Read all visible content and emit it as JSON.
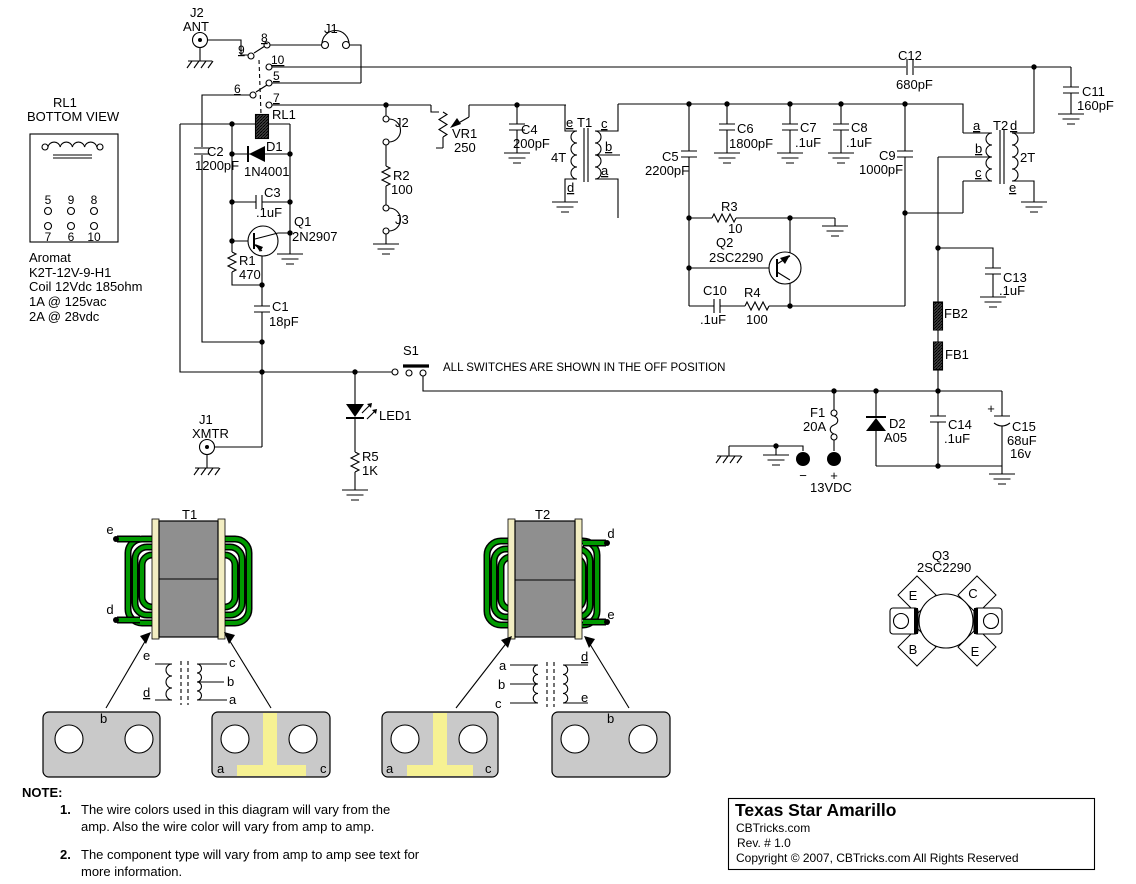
{
  "schematic_note": "ALL SWITCHES ARE SHOWN IN THE OFF POSITION",
  "title_block": {
    "title": "Texas Star  Amarillo",
    "site": "CBTricks.com",
    "rev": "Rev. # 1.0",
    "copyright": "Copyright © 2007, CBTricks.com All Rights Reserved"
  },
  "notes": {
    "heading": "NOTE:",
    "item1_num": "1.",
    "item1_line1": "The wire colors used in this diagram will vary from the",
    "item1_line2": "amp. Also the wire color will vary from amp to amp.",
    "item2_num": "2.",
    "item2_line1": "The component type will vary from amp to amp see text for",
    "item2_line2": "more information."
  },
  "relay_detail": {
    "ref": "RL1",
    "view": "BOTTOM VIEW",
    "pins_top": [
      "5",
      "9",
      "8"
    ],
    "pins_bottom": [
      "7",
      "6",
      "10"
    ],
    "mfr": "Aromat",
    "part": "K2T-12V-9-H1",
    "coil": "Coil 12Vdc  185ohm",
    "rating1": "1A @ 125vac",
    "rating2": "2A @ 28vdc"
  },
  "relay_pins": {
    "p5": "5",
    "p6": "6",
    "p7": "7",
    "p8": "8",
    "p9": "9",
    "p10": "10"
  },
  "components": {
    "J2_ANT": {
      "ref": "J2",
      "label": "ANT"
    },
    "J1_TOP": {
      "ref": "J1"
    },
    "J1_XMTR": {
      "ref": "J1",
      "label": "XMTR"
    },
    "J2_JMP": {
      "ref": "J2"
    },
    "J3_JMP": {
      "ref": "J3"
    },
    "RL1": {
      "ref": "RL1"
    },
    "S1": {
      "ref": "S1"
    },
    "LED1": {
      "ref": "LED1"
    },
    "C1": {
      "ref": "C1",
      "value": "18pF"
    },
    "C2": {
      "ref": "C2",
      "value": "1200pF"
    },
    "C3": {
      "ref": "C3",
      "value": ".1uF"
    },
    "C4": {
      "ref": "C4",
      "value": "200pF"
    },
    "C5": {
      "ref": "C5",
      "value": "2200pF"
    },
    "C6": {
      "ref": "C6",
      "value": "1800pF"
    },
    "C7": {
      "ref": "C7",
      "value": ".1uF"
    },
    "C8": {
      "ref": "C8",
      "value": ".1uF"
    },
    "C9": {
      "ref": "C9",
      "value": "1000pF"
    },
    "C10": {
      "ref": "C10",
      "value": ".1uF"
    },
    "C11": {
      "ref": "C11",
      "value": "160pF"
    },
    "C12": {
      "ref": "C12",
      "value": "680pF"
    },
    "C13": {
      "ref": "C13",
      "value": ".1uF"
    },
    "C14": {
      "ref": "C14",
      "value": ".1uF"
    },
    "C15": {
      "ref": "C15",
      "value": "68uF",
      "value2": "16v"
    },
    "R1": {
      "ref": "R1",
      "value": "470"
    },
    "R2": {
      "ref": "R2",
      "value": "100"
    },
    "R3": {
      "ref": "R3",
      "value": "10"
    },
    "R4": {
      "ref": "R4",
      "value": "100"
    },
    "R5": {
      "ref": "R5",
      "value": "1K"
    },
    "VR1": {
      "ref": "VR1",
      "value": "250"
    },
    "D1": {
      "ref": "D1",
      "value": "1N4001"
    },
    "D2": {
      "ref": "D2",
      "value": "A05"
    },
    "Q1": {
      "ref": "Q1",
      "value": "2N2907"
    },
    "Q2": {
      "ref": "Q2",
      "value": "2SC2290"
    },
    "FB1": {
      "ref": "FB1"
    },
    "FB2": {
      "ref": "FB2"
    },
    "T1": {
      "ref": "T1",
      "turns": "4T",
      "a": "a",
      "b": "b",
      "c": "c",
      "d": "d",
      "e": "e"
    },
    "T2": {
      "ref": "T2",
      "turns": "2T",
      "a": "a",
      "b": "b",
      "c": "c",
      "d": "d",
      "e": "e"
    }
  },
  "power": {
    "fuse_ref": "F1",
    "fuse_value": "20A",
    "plus": "+",
    "minus": "−",
    "supply": "13VDC",
    "c15_plus": "+"
  },
  "t1_detail": {
    "ref": "T1",
    "lead_e": "e",
    "lead_d": "d",
    "win_e": "e",
    "win_d": "d",
    "win_c": "c",
    "win_b": "b",
    "win_a": "a",
    "lug_b": "b",
    "lug_a": "a",
    "lug_c": "c"
  },
  "t2_detail": {
    "ref": "T2",
    "lead_d": "d",
    "lead_e": "e",
    "win_a": "a",
    "win_b": "b",
    "win_c": "c",
    "win_d": "d",
    "win_e": "e",
    "lug_a": "a",
    "lug_c": "c",
    "lug_b": "b"
  },
  "q3_detail": {
    "ref": "Q3",
    "part": "2SC2290",
    "e1": "E",
    "c": "C",
    "b": "B",
    "e2": "E"
  }
}
